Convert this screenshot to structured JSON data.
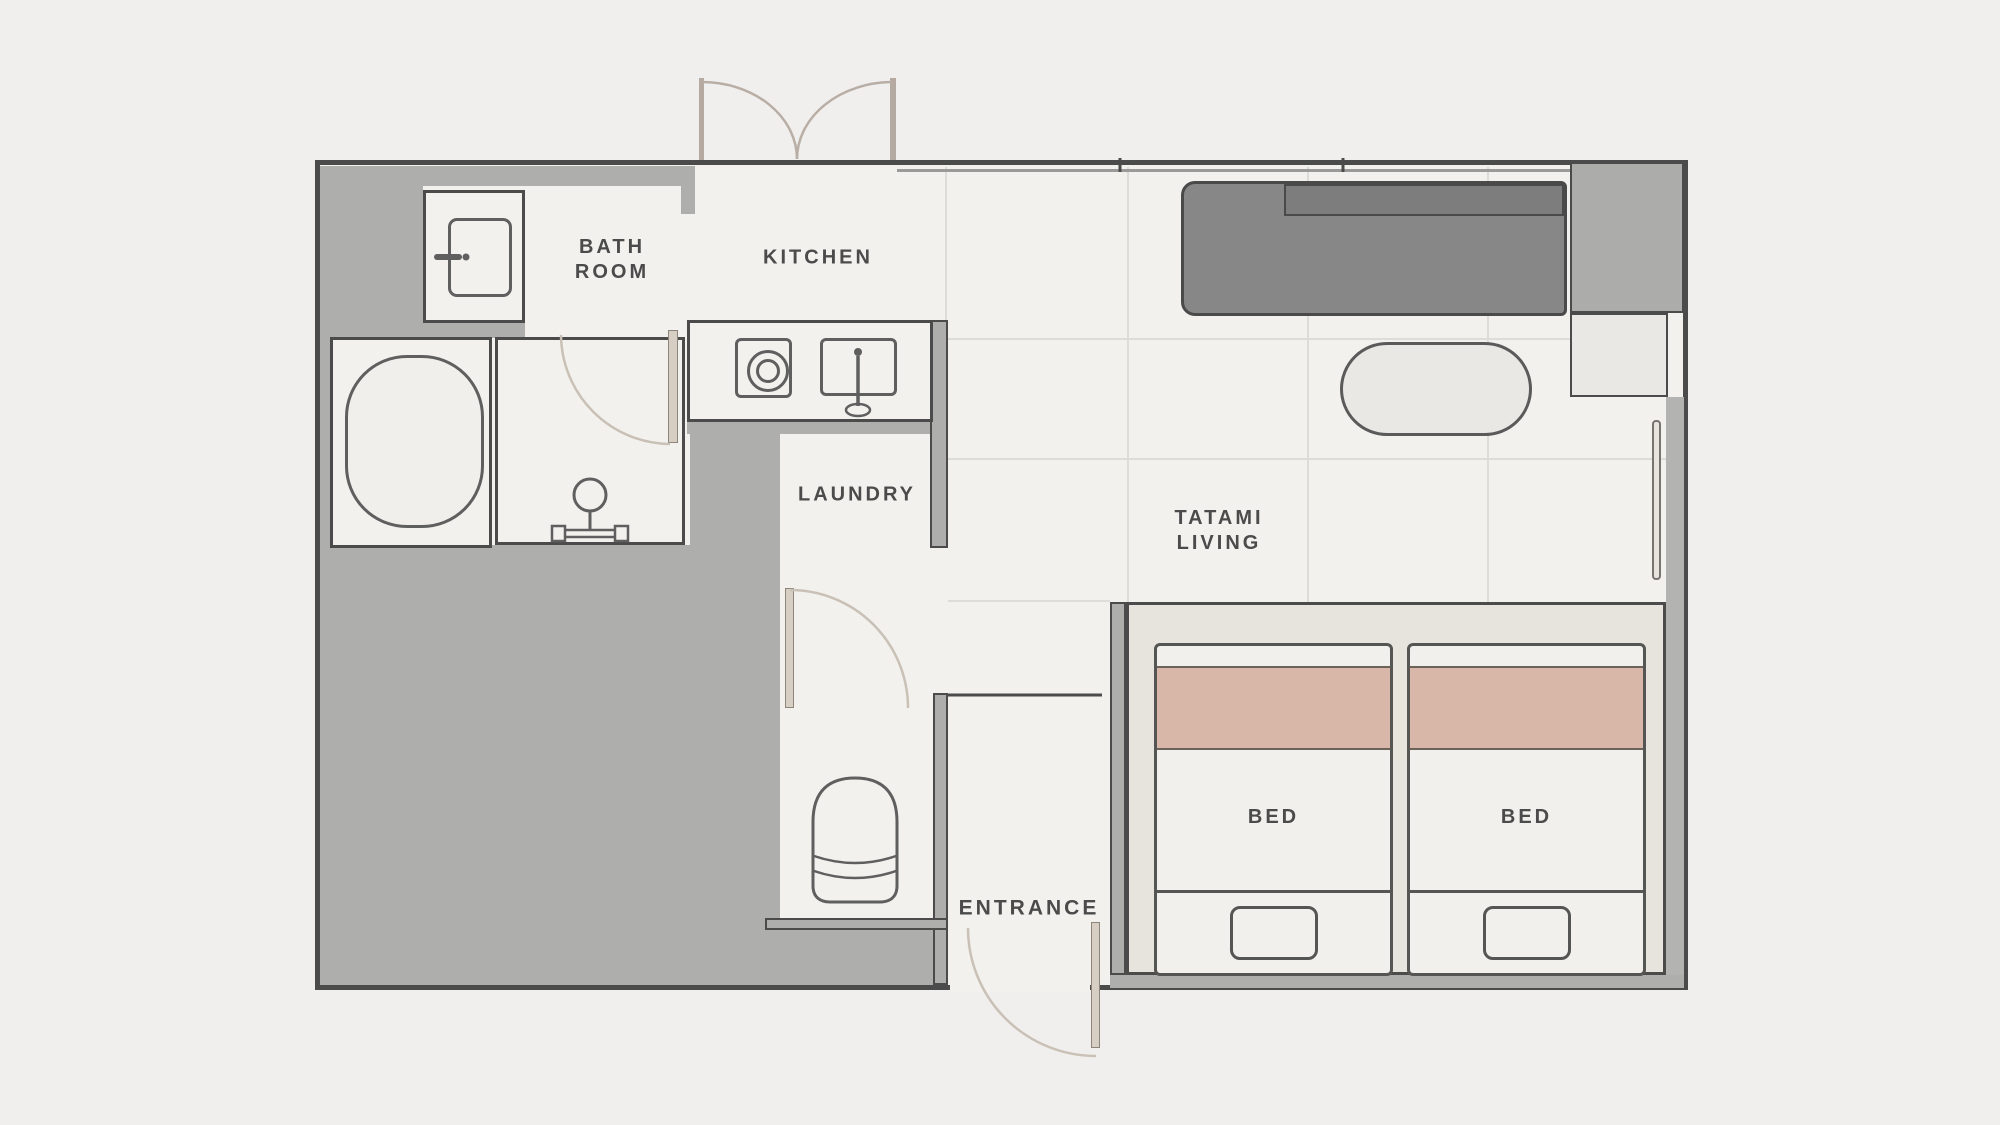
{
  "title": "apartment-floor-plan",
  "labels": {
    "bathroom_line1": "BATH",
    "bathroom_line2": "ROOM",
    "kitchen": "KITCHEN",
    "laundry": "LAUNDRY",
    "tatami_line1": "TATAMI",
    "tatami_line2": "LIVING",
    "entrance": "ENTRANCE",
    "bed_left": "BED",
    "bed_right": "BED"
  },
  "icons": {
    "bathtub-icon": "rounded rectangle tub",
    "toilet-icon": "toilet seen from above",
    "vanity-icon": "rounded cabinet with handle",
    "shower-icon": "shower head on stand",
    "stove-icon": "single burner circles",
    "sink-icon": "sink with faucet",
    "door-arc-icon": "quarter-circle door swing",
    "double-door-icon": "two-leaf swing door",
    "window-icon": "thin double-line window"
  },
  "colors": {
    "background": "#f0efed",
    "floor": "#f2f1ee",
    "wall_fill": "#aeaeac",
    "wall_outline": "#4b4b4b",
    "sofa": "#878787",
    "cabinet": "#acacaa",
    "blanket": "#d8b7a9",
    "platform": "#e7e4dd",
    "door_leaf": "#d8cfc4",
    "door_arc": "#c9c0b6",
    "label_text": "#4b4b4b"
  }
}
